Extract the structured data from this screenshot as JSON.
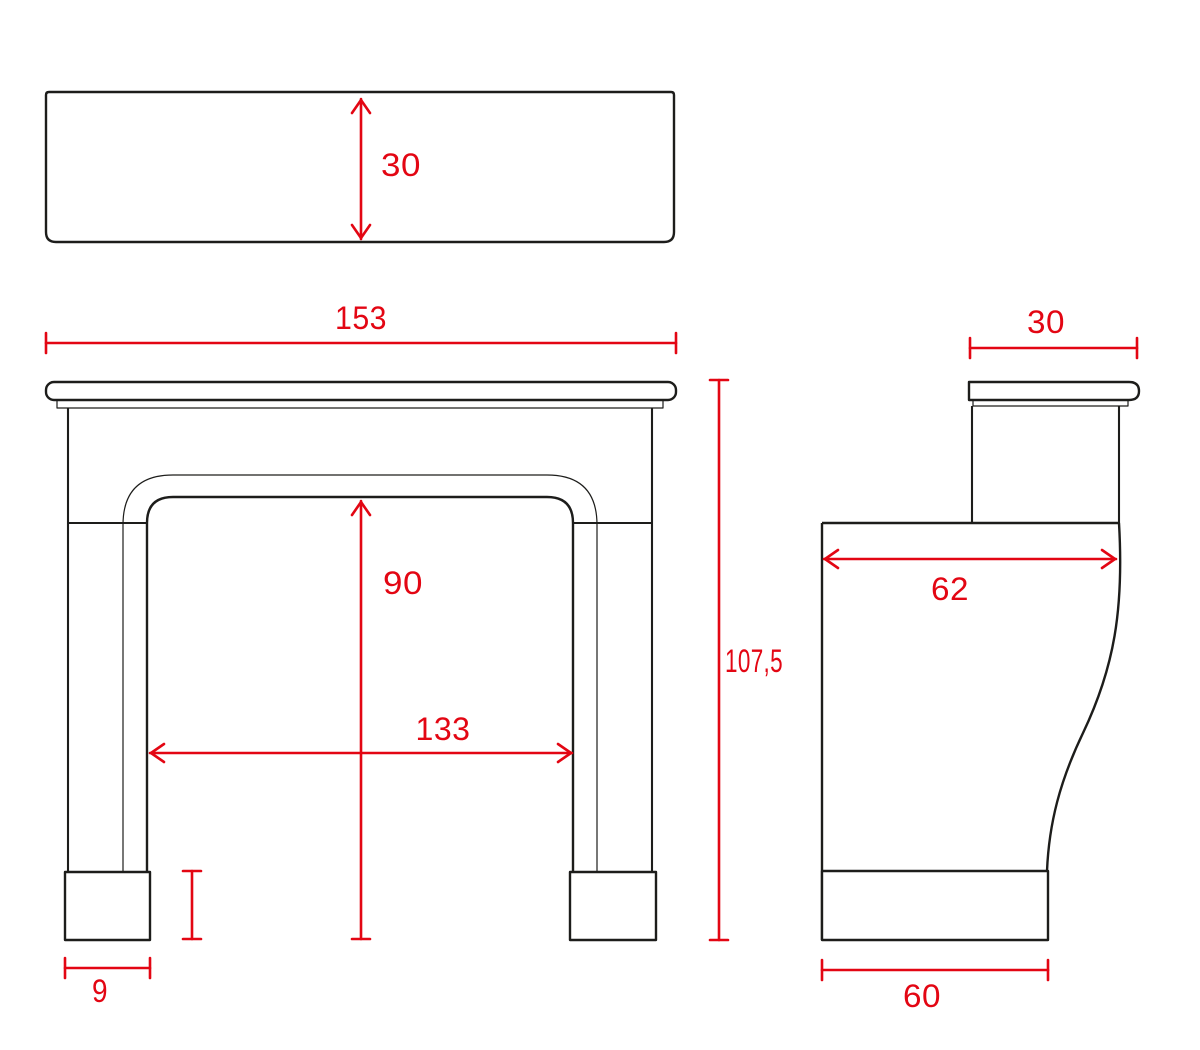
{
  "drawing": {
    "background_color": "#ffffff",
    "line_color": "#1d1d1b",
    "dimension_color": "#e30613",
    "views": {
      "top": {
        "dims": {
          "depth": "30"
        }
      },
      "front": {
        "dims": {
          "width": "153",
          "opening_height": "90",
          "opening_width": "133",
          "leg_width": "9",
          "height": "107,5"
        }
      },
      "side": {
        "dims": {
          "shelf_depth": "30",
          "body_depth": "62",
          "base_depth": "60"
        }
      }
    }
  }
}
